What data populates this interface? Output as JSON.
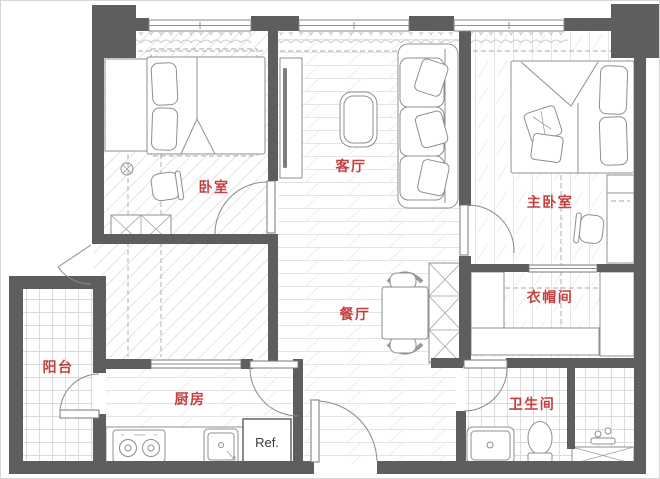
{
  "plan": {
    "title": "apartment-floor-plan",
    "rooms": {
      "bedroom": {
        "label": "卧室"
      },
      "living_room": {
        "label": "客厅"
      },
      "master_bedroom": {
        "label": "主卧室"
      },
      "closet": {
        "label": "衣帽间"
      },
      "dining_room": {
        "label": "餐厅"
      },
      "balcony": {
        "label": "阳台"
      },
      "kitchen": {
        "label": "厨房"
      },
      "bathroom": {
        "label": "卫生间"
      }
    },
    "appliances": {
      "refrigerator": {
        "label": "Ref."
      }
    },
    "colors": {
      "wall": "#5e5e5e",
      "room_label": "#c63f3f",
      "furniture_line": "#8f8f8f",
      "floor_hatch": "#e3e3e3",
      "tile_line": "#dcdcdc",
      "background": "#ffffff",
      "ref_text": "#3a3a3a"
    }
  }
}
